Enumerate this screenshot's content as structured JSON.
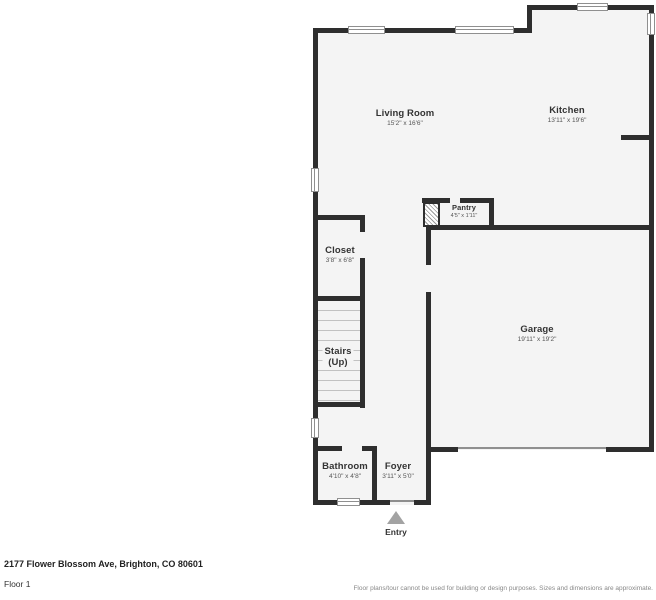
{
  "plan": {
    "rooms": {
      "living": {
        "name": "Living Room",
        "dims": "15'2\" x 16'6\""
      },
      "kitchen": {
        "name": "Kitchen",
        "dims": "13'11\" x 19'6\""
      },
      "pantry": {
        "name": "Pantry",
        "dims": "4'5\" x 1'11\""
      },
      "closet": {
        "name": "Closet",
        "dims": "3'8\" x 6'8\""
      },
      "stairs": {
        "name": "Stairs",
        "sub": "(Up)"
      },
      "garage": {
        "name": "Garage",
        "dims": "19'11\" x 19'2\""
      },
      "bathroom": {
        "name": "Bathroom",
        "dims": "4'10\" x 4'8\""
      },
      "foyer": {
        "name": "Foyer",
        "dims": "3'11\" x 5'0\""
      }
    },
    "entry_label": "Entry"
  },
  "footer": {
    "address": "2177 Flower Blossom Ave, Brighton, CO 80601",
    "floor": "Floor 1",
    "disclaimer": "Floor plans/tour cannot be used for building or design purposes. Sizes and dimensions are approximate."
  },
  "colors": {
    "wall": "#2e2e2e",
    "room_fill": "#f4f4f4",
    "label": "#333333",
    "dims": "#555555",
    "entry_arrow": "#a3a3a3"
  }
}
